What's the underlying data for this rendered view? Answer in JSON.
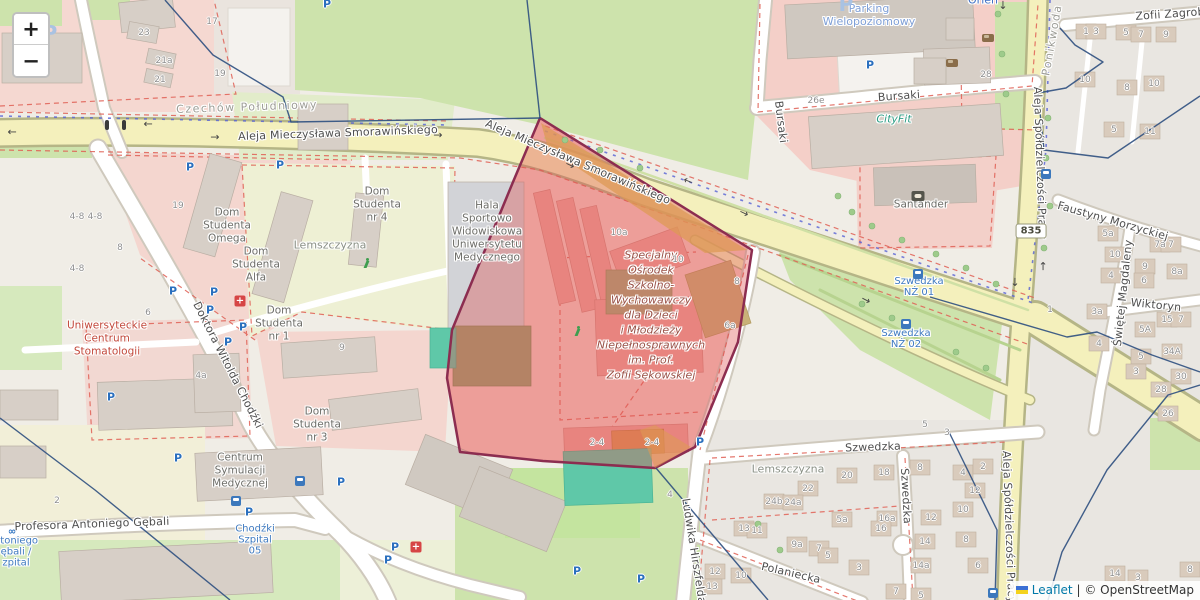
{
  "controls": {
    "zoom_in": "+",
    "zoom_out": "−"
  },
  "attribution": {
    "flag": "ukraine-flag-icon",
    "leaflet_link": "Leaflet",
    "separator": "|",
    "osm_text": "© OpenStreetMap"
  },
  "route_shield": {
    "text": "835",
    "x": 1031,
    "y": 231
  },
  "highlight_name": "Specjalny Ośrodek Szkolno-Wychowawczy dla Dzieci i Młodzieży Niepełnosprawnych im. Prof. Zofii Sękowskiej",
  "colors": {
    "highlight_fill": "#df5252",
    "highlight_border": "#8c2d50",
    "road_major": "#f4f0bc",
    "green": "#cde3ac",
    "pink": "#f5d3cc",
    "boundary": "#2e4f80",
    "teal_pitch": "#5fc8a8"
  },
  "street_labels": [
    {
      "text": "Aleja Mieczysława Smorawińskiego",
      "x": 338,
      "y": 133,
      "rot": -2,
      "cls": "street"
    },
    {
      "text": "Aleja Mieczysława Smorawińskiego",
      "x": 578,
      "y": 162,
      "rot": 23,
      "cls": "street"
    },
    {
      "text": "Bursaki",
      "x": 899,
      "y": 96,
      "rot": -4,
      "cls": "street"
    },
    {
      "text": "Bursaki",
      "x": 781,
      "y": 122,
      "rot": 83,
      "cls": "street"
    },
    {
      "text": "Doktora Witolda Chodźki",
      "x": 228,
      "y": 365,
      "rot": 63,
      "cls": "street"
    },
    {
      "text": "Profesora Antoniego Gębali",
      "x": 92,
      "y": 524,
      "rot": -2,
      "cls": "street"
    },
    {
      "text": "Szwedzka",
      "x": 873,
      "y": 447,
      "rot": -2,
      "cls": "street"
    },
    {
      "text": "Szwedzka",
      "x": 906,
      "y": 496,
      "rot": 87,
      "cls": "street"
    },
    {
      "text": "Polaniecka",
      "x": 791,
      "y": 573,
      "rot": 13,
      "cls": "street"
    },
    {
      "text": "Ludwika Hirszfelda",
      "x": 694,
      "y": 551,
      "rot": 81,
      "cls": "street"
    },
    {
      "text": "Wiktoryn",
      "x": 1156,
      "y": 305,
      "rot": 6,
      "cls": "street"
    },
    {
      "text": "Świętej Magdaleny",
      "x": 1123,
      "y": 293,
      "rot": -84,
      "cls": "street"
    },
    {
      "text": "Faustyny Morzyckiej",
      "x": 1113,
      "y": 221,
      "rot": 16,
      "cls": "street"
    },
    {
      "text": "Zofii Zagrob",
      "x": 1170,
      "y": 14,
      "rot": -4,
      "cls": "street"
    },
    {
      "text": "Aleja Spółdzielczości Pracy",
      "x": 1040,
      "y": 163,
      "rot": 88,
      "cls": "street"
    },
    {
      "text": "Aleja Spółdzielczości Pracy",
      "x": 1009,
      "y": 527,
      "rot": 88,
      "cls": "street"
    },
    {
      "text": "Czechów Południowy",
      "x": 247,
      "y": 107,
      "rot": -2,
      "cls": "district"
    },
    {
      "text": "Ponikwoda",
      "x": 1052,
      "y": 40,
      "rot": -80,
      "cls": "district"
    }
  ],
  "place_labels": [
    {
      "lines": [
        "Hala",
        "Sportowo",
        "Widowiskowa",
        "Uniwersytetu",
        "Medycznego"
      ],
      "x": 487,
      "y": 206,
      "cls": "poi"
    },
    {
      "lines": [
        "Dom",
        "Studenta",
        "Omega"
      ],
      "x": 227,
      "y": 213,
      "cls": "poi"
    },
    {
      "lines": [
        "Dom",
        "Studenta",
        "Alfa"
      ],
      "x": 256,
      "y": 252,
      "cls": "poi"
    },
    {
      "lines": [
        "Dom",
        "Studenta",
        "nr 4"
      ],
      "x": 377,
      "y": 192,
      "cls": "poi"
    },
    {
      "lines": [
        "Dom",
        "Studenta",
        "nr 1"
      ],
      "x": 279,
      "y": 311,
      "cls": "poi"
    },
    {
      "lines": [
        "Dom",
        "Studenta",
        "nr 3"
      ],
      "x": 317,
      "y": 412,
      "cls": "poi"
    },
    {
      "lines": [
        "Lemszczyzna"
      ],
      "x": 330,
      "y": 245,
      "cls": "area"
    },
    {
      "lines": [
        "Lemszczyzna"
      ],
      "x": 788,
      "y": 469,
      "cls": "area"
    },
    {
      "lines": [
        "Centrum",
        "Symulacji",
        "Medycznej"
      ],
      "x": 240,
      "y": 458,
      "cls": "poi"
    },
    {
      "lines": [
        "Uniwersyteckie",
        "Centrum",
        "Stomatologii"
      ],
      "x": 107,
      "y": 326,
      "cls": "poi poi-red"
    },
    {
      "lines": [
        "CityFit"
      ],
      "x": 894,
      "y": 119,
      "cls": "gym"
    },
    {
      "lines": [
        "Santander"
      ],
      "x": 921,
      "y": 205,
      "cls": "poi"
    },
    {
      "lines": [
        "Orlen"
      ],
      "x": 983,
      "y": 0,
      "cls": "fuel"
    },
    {
      "lines": [
        "Parking",
        "Wielopoziomowy"
      ],
      "x": 869,
      "y": 8,
      "cls": "parking-name"
    },
    {
      "lines": [
        "Specjalny",
        "Ośrodek",
        "Szkolno-",
        "Wychowawczy",
        "dla Dzieci",
        "i Młodzieży",
        "Niepełnosprawnych",
        "im. Prof.",
        "Zofii Sękowskiej"
      ],
      "x": 651,
      "y": 263,
      "cls": "school"
    }
  ],
  "bus_stop_labels": [
    {
      "lines": [
        "Szwedzka",
        "NŻ 01"
      ],
      "x": 919,
      "y": 281
    },
    {
      "lines": [
        "Szwedzka",
        "NŻ 02"
      ],
      "x": 906,
      "y": 333
    },
    {
      "lines": [
        "Chodźki",
        "Szpital",
        "05"
      ],
      "x": 255,
      "y": 529
    },
    {
      "lines": [
        "ntoniego",
        "ębali /",
        "zpital"
      ],
      "x": 16,
      "y": 541
    }
  ],
  "house_numbers": [
    {
      "t": "17",
      "x": 212,
      "y": 22
    },
    {
      "t": "23",
      "x": 144,
      "y": 33
    },
    {
      "t": "21a",
      "x": 164,
      "y": 61
    },
    {
      "t": "21",
      "x": 160,
      "y": 80
    },
    {
      "t": "19",
      "x": 220,
      "y": 74
    },
    {
      "t": "19",
      "x": 178,
      "y": 206
    },
    {
      "t": "4-8",
      "x": 77,
      "y": 217
    },
    {
      "t": "4-8",
      "x": 95,
      "y": 217
    },
    {
      "t": "8",
      "x": 120,
      "y": 248
    },
    {
      "t": "4-8",
      "x": 77,
      "y": 269
    },
    {
      "t": "6",
      "x": 148,
      "y": 313
    },
    {
      "t": "4a",
      "x": 201,
      "y": 376
    },
    {
      "t": "2",
      "x": 57,
      "y": 501
    },
    {
      "t": "9",
      "x": 342,
      "y": 348
    },
    {
      "t": "10a",
      "x": 619,
      "y": 233
    },
    {
      "t": "10",
      "x": 678,
      "y": 260
    },
    {
      "t": "8",
      "x": 737,
      "y": 282
    },
    {
      "t": "6a",
      "x": 730,
      "y": 326
    },
    {
      "t": "2-4",
      "x": 597,
      "y": 443
    },
    {
      "t": "2-4",
      "x": 652,
      "y": 443
    },
    {
      "t": "4",
      "x": 670,
      "y": 495
    },
    {
      "t": "26e",
      "x": 816,
      "y": 101
    },
    {
      "t": "28",
      "x": 986,
      "y": 75
    },
    {
      "t": "20",
      "x": 847,
      "y": 476
    },
    {
      "t": "18",
      "x": 884,
      "y": 473
    },
    {
      "t": "22",
      "x": 808,
      "y": 489
    },
    {
      "t": "24b",
      "x": 774,
      "y": 502
    },
    {
      "t": "24a",
      "x": 793,
      "y": 503
    },
    {
      "t": "5a",
      "x": 842,
      "y": 520
    },
    {
      "t": "16a",
      "x": 887,
      "y": 519
    },
    {
      "t": "16",
      "x": 881,
      "y": 529
    },
    {
      "t": "13",
      "x": 744,
      "y": 529
    },
    {
      "t": "11",
      "x": 757,
      "y": 531
    },
    {
      "t": "9a",
      "x": 797,
      "y": 545
    },
    {
      "t": "7",
      "x": 819,
      "y": 549
    },
    {
      "t": "5",
      "x": 828,
      "y": 556
    },
    {
      "t": "3",
      "x": 859,
      "y": 568
    },
    {
      "t": "12",
      "x": 715,
      "y": 572
    },
    {
      "t": "10",
      "x": 741,
      "y": 576
    },
    {
      "t": "13",
      "x": 712,
      "y": 587
    },
    {
      "t": "8",
      "x": 920,
      "y": 468
    },
    {
      "t": "4",
      "x": 963,
      "y": 473
    },
    {
      "t": "2",
      "x": 983,
      "y": 467
    },
    {
      "t": "12",
      "x": 975,
      "y": 491
    },
    {
      "t": "10",
      "x": 963,
      "y": 510
    },
    {
      "t": "12",
      "x": 931,
      "y": 518
    },
    {
      "t": "14",
      "x": 925,
      "y": 542
    },
    {
      "t": "8",
      "x": 966,
      "y": 540
    },
    {
      "t": "14a",
      "x": 921,
      "y": 566
    },
    {
      "t": "6",
      "x": 978,
      "y": 566
    },
    {
      "t": "7",
      "x": 896,
      "y": 592
    },
    {
      "t": "5",
      "x": 921,
      "y": 596
    },
    {
      "t": "5",
      "x": 925,
      "y": 425
    },
    {
      "t": "3",
      "x": 947,
      "y": 433
    },
    {
      "t": "1",
      "x": 1086,
      "y": 32
    },
    {
      "t": "3",
      "x": 1096,
      "y": 32
    },
    {
      "t": "5",
      "x": 1126,
      "y": 33
    },
    {
      "t": "7",
      "x": 1141,
      "y": 35
    },
    {
      "t": "9",
      "x": 1166,
      "y": 35
    },
    {
      "t": "10",
      "x": 1085,
      "y": 80
    },
    {
      "t": "8",
      "x": 1127,
      "y": 88
    },
    {
      "t": "10",
      "x": 1154,
      "y": 84
    },
    {
      "t": "5",
      "x": 1114,
      "y": 130
    },
    {
      "t": "11",
      "x": 1150,
      "y": 132
    },
    {
      "t": "5a",
      "x": 1108,
      "y": 234
    },
    {
      "t": "7a",
      "x": 1160,
      "y": 245
    },
    {
      "t": "7",
      "x": 1171,
      "y": 245
    },
    {
      "t": "10",
      "x": 1115,
      "y": 255
    },
    {
      "t": "9",
      "x": 1145,
      "y": 267
    },
    {
      "t": "8a",
      "x": 1177,
      "y": 272
    },
    {
      "t": "6",
      "x": 1144,
      "y": 281
    },
    {
      "t": "4",
      "x": 1111,
      "y": 276
    },
    {
      "t": "1",
      "x": 1050,
      "y": 310
    },
    {
      "t": "3a",
      "x": 1097,
      "y": 312
    },
    {
      "t": "4",
      "x": 1099,
      "y": 344
    },
    {
      "t": "5",
      "x": 1141,
      "y": 357
    },
    {
      "t": "3",
      "x": 1136,
      "y": 372
    },
    {
      "t": "15",
      "x": 1167,
      "y": 320
    },
    {
      "t": "7",
      "x": 1181,
      "y": 320
    },
    {
      "t": "5A",
      "x": 1145,
      "y": 330
    },
    {
      "t": "34A",
      "x": 1172,
      "y": 352
    },
    {
      "t": "30",
      "x": 1181,
      "y": 377
    },
    {
      "t": "28",
      "x": 1161,
      "y": 390
    },
    {
      "t": "26",
      "x": 1168,
      "y": 414
    },
    {
      "t": "14",
      "x": 1115,
      "y": 574
    },
    {
      "t": "3",
      "x": 1138,
      "y": 578
    },
    {
      "t": "8",
      "x": 1190,
      "y": 570
    }
  ],
  "icons": [
    {
      "type": "parking",
      "x": 50,
      "y": 33,
      "size": "lg"
    },
    {
      "type": "parking",
      "x": 846,
      "y": 4,
      "size": "lg"
    },
    {
      "type": "parking",
      "x": 327,
      "y": 4
    },
    {
      "type": "parking",
      "x": 190,
      "y": 167
    },
    {
      "type": "parking",
      "x": 280,
      "y": 165
    },
    {
      "type": "parking",
      "x": 173,
      "y": 291
    },
    {
      "type": "parking",
      "x": 214,
      "y": 292
    },
    {
      "type": "parking",
      "x": 210,
      "y": 310
    },
    {
      "type": "parking",
      "x": 243,
      "y": 327
    },
    {
      "type": "parking",
      "x": 228,
      "y": 342
    },
    {
      "type": "parking",
      "x": 111,
      "y": 397
    },
    {
      "type": "parking",
      "x": 178,
      "y": 458
    },
    {
      "type": "parking",
      "x": 341,
      "y": 482
    },
    {
      "type": "parking",
      "x": 249,
      "y": 512
    },
    {
      "type": "parking",
      "x": 395,
      "y": 547
    },
    {
      "type": "parking",
      "x": 388,
      "y": 560
    },
    {
      "type": "parking",
      "x": 577,
      "y": 571
    },
    {
      "type": "parking",
      "x": 641,
      "y": 579
    },
    {
      "type": "parking",
      "x": 700,
      "y": 442
    },
    {
      "type": "parking",
      "x": 870,
      "y": 65
    },
    {
      "type": "bus",
      "x": 918,
      "y": 274
    },
    {
      "type": "bus",
      "x": 906,
      "y": 324
    },
    {
      "type": "bus",
      "x": 300,
      "y": 481
    },
    {
      "type": "bus",
      "x": 236,
      "y": 501
    },
    {
      "type": "bus",
      "x": 1046,
      "y": 174
    },
    {
      "type": "bus",
      "x": 993,
      "y": 593
    },
    {
      "type": "hospital",
      "x": 416,
      "y": 547
    },
    {
      "type": "pharmacy",
      "x": 240,
      "y": 301
    },
    {
      "type": "atm",
      "x": 918,
      "y": 196
    },
    {
      "type": "car",
      "x": 952,
      "y": 63
    },
    {
      "type": "car",
      "x": 988,
      "y": 38
    },
    {
      "type": "runner",
      "x": 367,
      "y": 263
    },
    {
      "type": "runner",
      "x": 578,
      "y": 331
    },
    {
      "type": "bicycle",
      "x": 12,
      "y": 532
    },
    {
      "type": "traffic",
      "x": 107,
      "y": 125
    },
    {
      "type": "traffic",
      "x": 124,
      "y": 125
    },
    {
      "type": "arrow",
      "x": 12,
      "y": 132,
      "rot": 180
    },
    {
      "type": "arrow",
      "x": 148,
      "y": 124,
      "rot": 180
    },
    {
      "type": "arrow",
      "x": 215,
      "y": 137,
      "rot": 0
    },
    {
      "type": "arrow",
      "x": 438,
      "y": 135,
      "rot": 0
    },
    {
      "type": "arrow",
      "x": 570,
      "y": 165,
      "rot": 25
    },
    {
      "type": "arrow",
      "x": 688,
      "y": 181,
      "rot": 203
    },
    {
      "type": "arrow",
      "x": 744,
      "y": 213,
      "rot": 25
    },
    {
      "type": "arrow",
      "x": 866,
      "y": 300,
      "rot": 27
    },
    {
      "type": "arrow",
      "x": 1043,
      "y": 266,
      "rot": -90
    },
    {
      "type": "arrow",
      "x": 1015,
      "y": 282,
      "rot": 90
    },
    {
      "type": "arrow",
      "x": 1003,
      "y": 5,
      "rot": 90
    }
  ]
}
